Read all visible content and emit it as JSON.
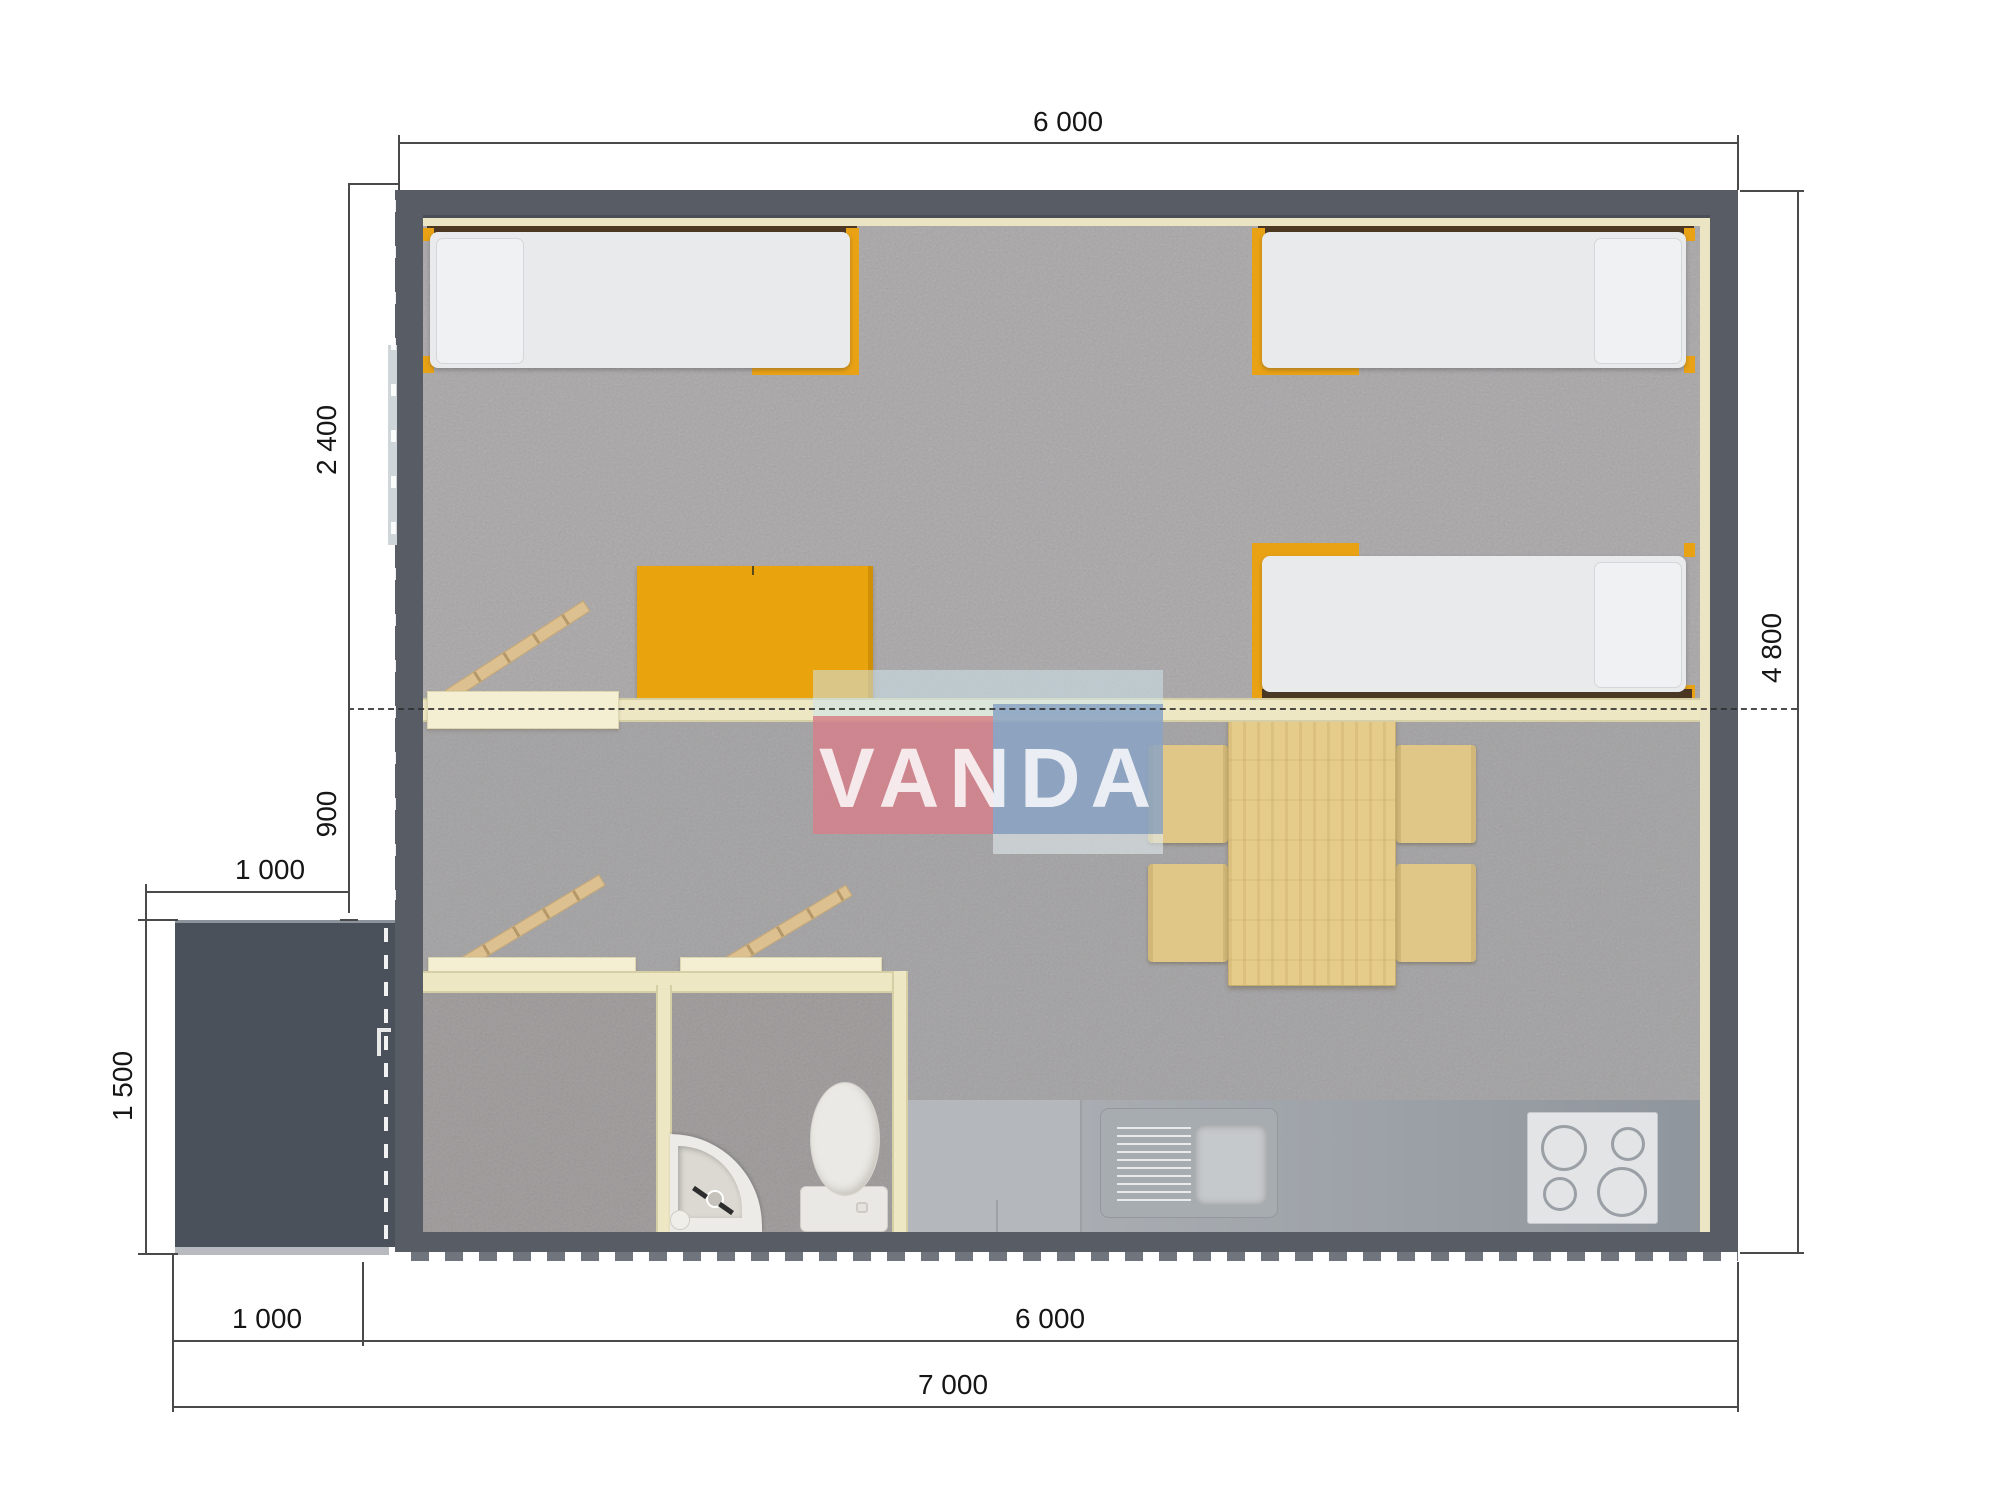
{
  "title": "prefab-cabin-floor-plan",
  "watermark": {
    "text": "VANDA"
  },
  "dimensions": {
    "top_width": "6 000",
    "bedroom_depth": "2 400",
    "hall_depth": "900",
    "porch_width_top": "1 000",
    "porch_depth": "1 500",
    "bottom_porch_width": "1 000",
    "bottom_house_width": "6 000",
    "bottom_total_width": "7 000",
    "house_depth": "4 800"
  },
  "colors": {
    "wall": "#575c65",
    "porch": "#4b515b",
    "carpet": "#a9a6a8",
    "bed_frame_orange": "#e9a214",
    "wardrobe_orange": "#e8a30d",
    "partition_cream": "#eee7c4",
    "wood_table": "#e6cc8b",
    "chair": "#e0c687",
    "counter_gray": "#9da3aa",
    "watermark_pink": "#d5808b",
    "watermark_blue": "#8aa3c4",
    "watermark_band": "#cde4eb"
  }
}
